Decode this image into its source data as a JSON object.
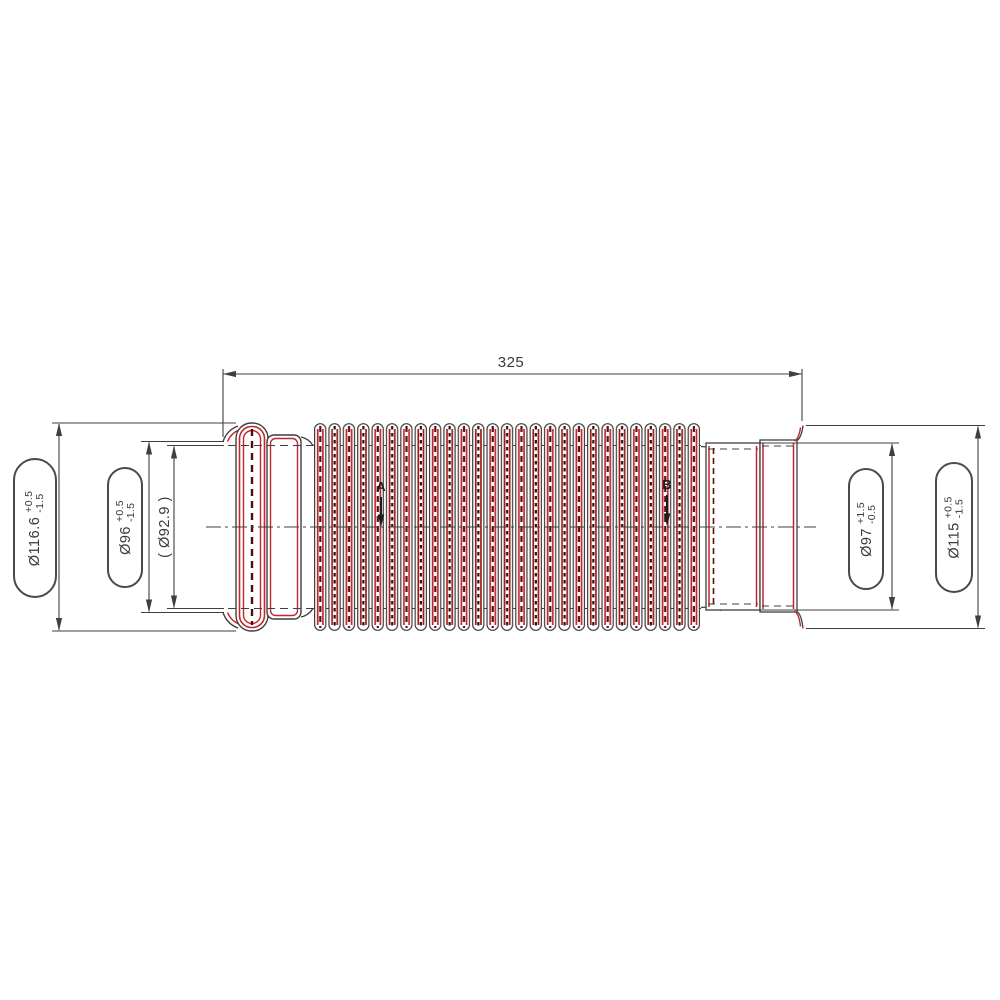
{
  "drawing": {
    "length_dim": {
      "value": "325"
    },
    "diameter_dims": [
      {
        "id": "left-flange-od",
        "label": "Ø116.6",
        "tol_plus": "+0.5",
        "tol_minus": "-1.5",
        "boxed": true
      },
      {
        "id": "left-opening-od",
        "label": "Ø96",
        "tol_plus": "+0.5",
        "tol_minus": "-1.5",
        "boxed": true
      },
      {
        "id": "reference-id",
        "label": "( Ø92.9 )",
        "tol_plus": "",
        "tol_minus": "",
        "boxed": false
      },
      {
        "id": "right-neck-od",
        "label": "Ø97",
        "tol_plus": "+1.5",
        "tol_minus": "-0.5",
        "boxed": true
      },
      {
        "id": "right-opening-od",
        "label": "Ø115",
        "tol_plus": "+0.5",
        "tol_minus": "-1.5",
        "boxed": true
      }
    ],
    "callouts": [
      {
        "label": "A"
      },
      {
        "label": "B"
      }
    ],
    "colors": {
      "line": "#3f3f3f",
      "red": "#c1272d",
      "dark_red": "#5a1212",
      "text": "#3a3a3a",
      "background": "#ffffff"
    }
  }
}
